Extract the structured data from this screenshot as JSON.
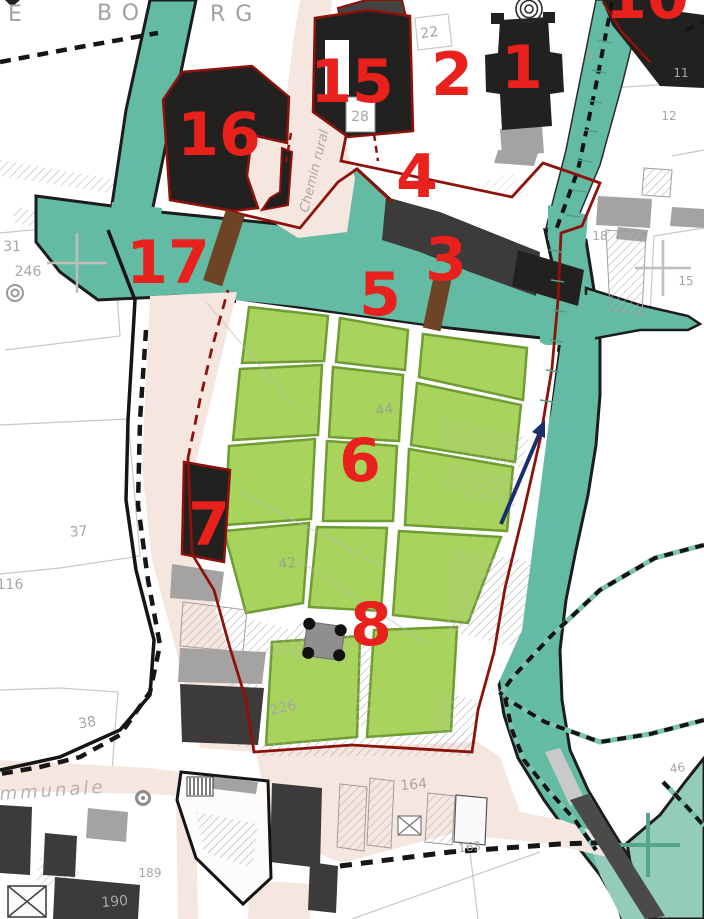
{
  "map": {
    "kind": "cadastral heritage site map",
    "place_name_fragments": [
      "E",
      "BO",
      "RG"
    ],
    "street_names": [
      "Chemin rural",
      "mmunale"
    ],
    "site_marker_numbers": [
      "1",
      "2",
      "3",
      "4",
      "5",
      "6",
      "7",
      "8",
      "10",
      "15",
      "16",
      "17"
    ],
    "parcel_numbers": [
      "22",
      "28",
      "9",
      "11",
      "12",
      "18",
      "15",
      "31",
      "246",
      "37",
      "116",
      "38",
      "190",
      "189",
      "226",
      "42",
      "44",
      "164",
      "163",
      "46"
    ]
  },
  "labels": {
    "sites": [
      {
        "text": "1"
      },
      {
        "text": "2"
      },
      {
        "text": "3"
      },
      {
        "text": "4"
      },
      {
        "text": "5"
      },
      {
        "text": "6"
      },
      {
        "text": "7"
      },
      {
        "text": "8"
      },
      {
        "text": "10"
      },
      {
        "text": "15"
      },
      {
        "text": "16"
      },
      {
        "text": "17"
      }
    ],
    "parcels": [
      {
        "text": "22"
      },
      {
        "text": "28"
      },
      {
        "text": "9"
      },
      {
        "text": "11"
      },
      {
        "text": "12"
      },
      {
        "text": "18"
      },
      {
        "text": "15"
      },
      {
        "text": "31"
      },
      {
        "text": "246"
      },
      {
        "text": "37"
      },
      {
        "text": "116"
      },
      {
        "text": "38"
      },
      {
        "text": "190"
      },
      {
        "text": "189"
      },
      {
        "text": "226"
      },
      {
        "text": "42"
      },
      {
        "text": "44"
      },
      {
        "text": "164"
      },
      {
        "text": "163"
      },
      {
        "text": "46"
      }
    ],
    "streets": [
      {
        "text": "Chemin rural"
      },
      {
        "text": "mmunale"
      }
    ],
    "place": [
      {
        "text": "E"
      },
      {
        "text": "BO"
      },
      {
        "text": "RG"
      }
    ]
  },
  "colors": {
    "site_number_red": "#e8211d",
    "boundary_dark_red": "#8e120c",
    "water_teal": "#64bba4",
    "water_teal_light": "#93ccba",
    "garden_green_fill": "#a8d45e",
    "garden_green_border": "#6f9c33",
    "road_beige": "#f5e7e0",
    "building_black": "#232020",
    "building_dark_gray": "#3c3a3b",
    "building_gray": "#a5a3a2",
    "gate_brown": "#6d4425",
    "flow_arrow_navy": "#1b2f6e",
    "parcel_text_gray": "#a8a6a3"
  },
  "symbols": [
    "spiral-monument-icon",
    "well-icon",
    "monument-platform-icon",
    "gate-marker",
    "flow-direction-arrow-icon",
    "survey-cross-icon",
    "ruin-cross-icon",
    "covered-passage-icon"
  ]
}
